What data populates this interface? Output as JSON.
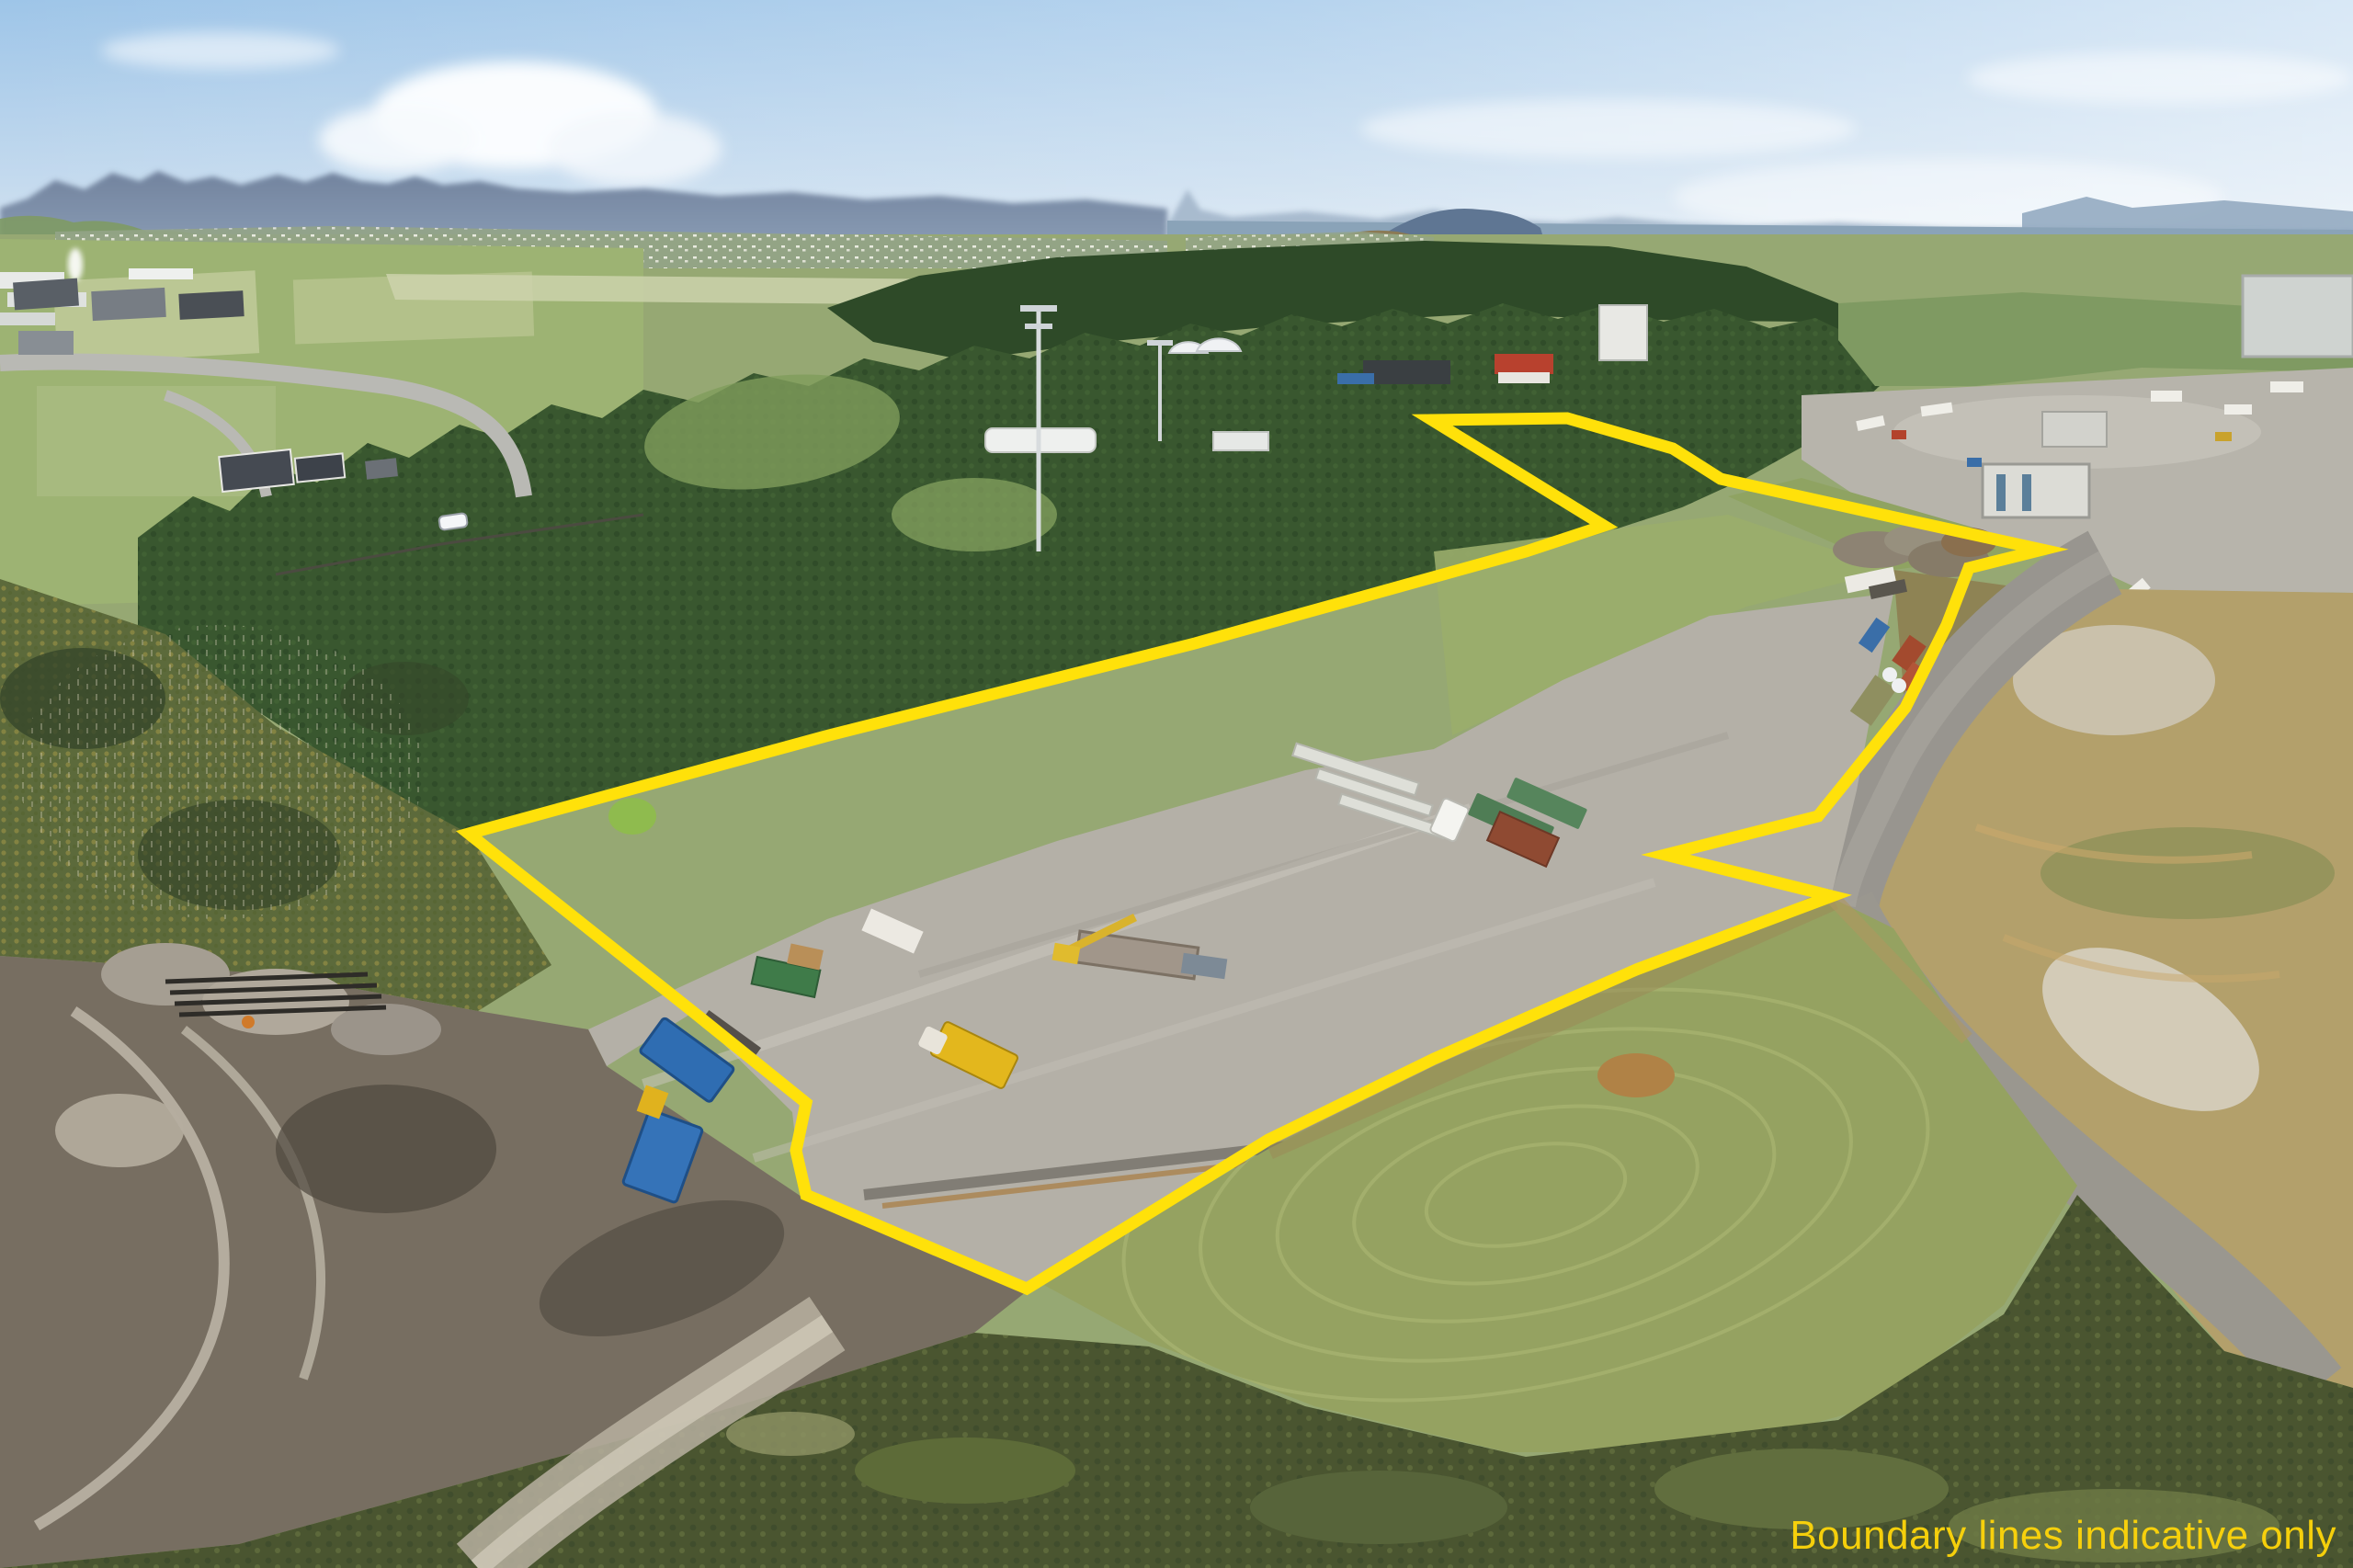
{
  "caption": {
    "text": "Boundary lines indicative only",
    "color": "#ffd60a"
  },
  "boundary": {
    "color": "#ffe10a",
    "stroke_width": 13,
    "points": [
      [
        1558,
        457
      ],
      [
        1705,
        455
      ],
      [
        1820,
        488
      ],
      [
        1872,
        521
      ],
      [
        2048,
        560
      ],
      [
        2222,
        598
      ],
      [
        2142,
        618
      ],
      [
        2118,
        680
      ],
      [
        2073,
        770
      ],
      [
        1978,
        888
      ],
      [
        1812,
        930
      ],
      [
        1993,
        975
      ],
      [
        1780,
        1055
      ],
      [
        1560,
        1152
      ],
      [
        1380,
        1240
      ],
      [
        1117,
        1402
      ],
      [
        877,
        1300
      ],
      [
        866,
        1252
      ],
      [
        877,
        1200
      ],
      [
        753,
        1100
      ],
      [
        510,
        907
      ],
      [
        700,
        855
      ],
      [
        902,
        800
      ],
      [
        1300,
        700
      ],
      [
        1660,
        600
      ],
      [
        1745,
        572
      ]
    ]
  },
  "palette": {
    "sky_top": "#9ec5e8",
    "sky_haze": "#e3ecf3",
    "mountains": "#72839e",
    "water": "#8aa3b8",
    "forest": "#39572f",
    "scrub": "#5c6a3b",
    "pasture": "#9db373",
    "gravel_pad": "#b4b0a7",
    "paddock": "#95a261",
    "dirt_field": "#b3a06b",
    "mud": "#776e61",
    "road": "#98958f"
  }
}
